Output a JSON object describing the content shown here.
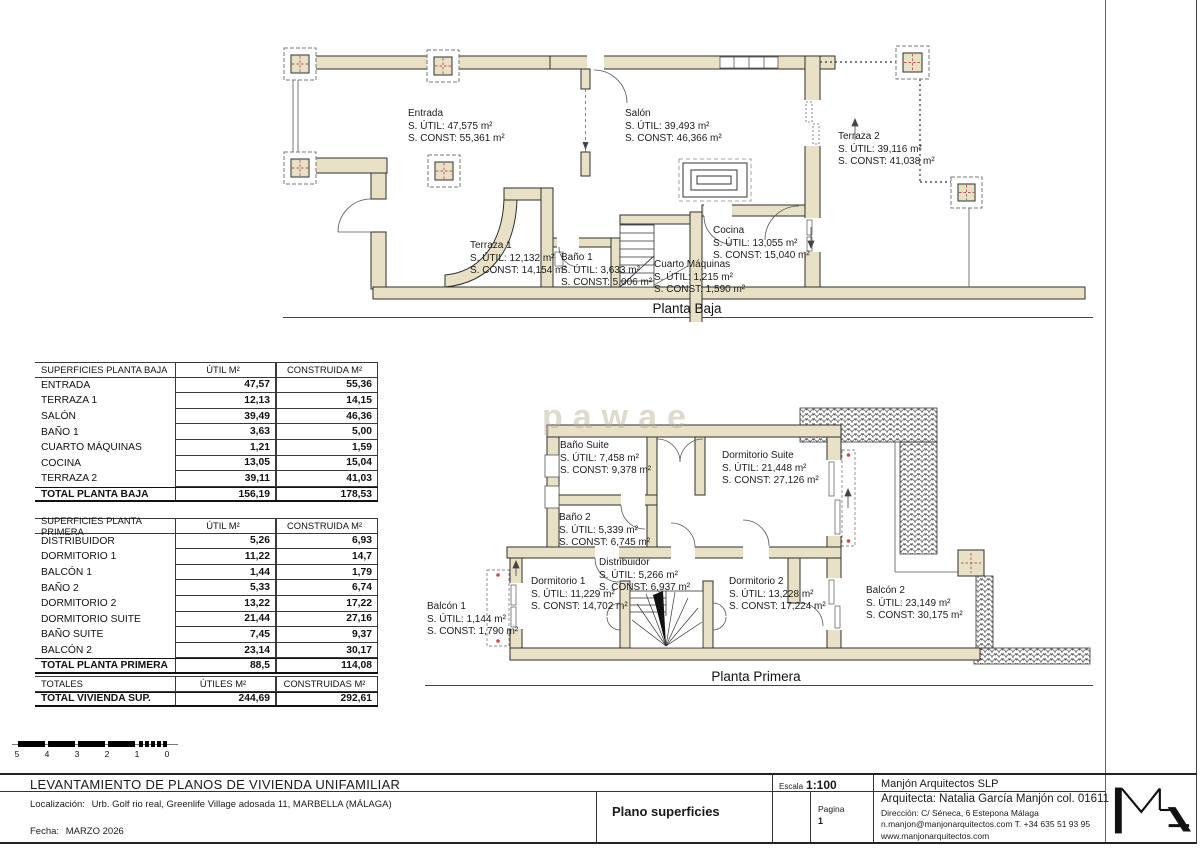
{
  "watermark": "pawae",
  "plans": {
    "planta_baja": {
      "caption": "Planta Baja",
      "rooms": [
        {
          "id": "entrada",
          "lines": [
            "Entrada",
            "S. ÚTIL: 47,575 m²",
            "S. CONST: 55,361 m²"
          ]
        },
        {
          "id": "salon",
          "lines": [
            "Salón",
            "S. ÚTIL: 39,493 m²",
            "S. CONST: 46,366 m²"
          ]
        },
        {
          "id": "terraza2",
          "lines": [
            "Terraza 2",
            "S. ÚTIL: 39,116 m²",
            "S. CONST: 41,038 m²"
          ]
        },
        {
          "id": "terraza1",
          "lines": [
            "Terraza 1",
            "S. ÚTIL: 12,132 m²",
            "S. CONST: 14,154 m²"
          ]
        },
        {
          "id": "bano1",
          "lines": [
            "Baño 1",
            "S. ÚTIL: 3,633 m²",
            "S. CONST: 5,006 m²"
          ]
        },
        {
          "id": "cuarto_maquinas",
          "lines": [
            "Cuarto Máquinas",
            "S. ÚTIL: 1,215 m²",
            "S. CONST: 1,590 m²"
          ]
        },
        {
          "id": "cocina",
          "lines": [
            "Cocina",
            "S. ÚTIL: 13,055 m²",
            "S. CONST: 15,040 m²"
          ]
        }
      ]
    },
    "planta_primera": {
      "caption": "Planta Primera",
      "rooms": [
        {
          "id": "bano_suite",
          "lines": [
            "Baño Suite",
            "S. ÚTIL: 7,458 m²",
            "S. CONST: 9,378 m²"
          ]
        },
        {
          "id": "dormitorio_suite",
          "lines": [
            "Dormitorio Suite",
            "S. ÚTIL: 21,448 m²",
            "S. CONST: 27,126 m²"
          ]
        },
        {
          "id": "bano2",
          "lines": [
            "Baño 2",
            "S. ÚTIL: 5,339 m²",
            "S. CONST: 6,745 m²"
          ]
        },
        {
          "id": "distribuidor",
          "lines": [
            "Distribuidor",
            "S. ÚTIL: 5,266 m²",
            "S. CONST: 6,937 m²"
          ]
        },
        {
          "id": "dormitorio1",
          "lines": [
            "Dormitorio 1",
            "S. ÚTIL: 11,229 m²",
            "S. CONST: 14,702 m²"
          ]
        },
        {
          "id": "dormitorio2",
          "lines": [
            "Dormitorio 2",
            "S. ÚTIL: 13,228 m²",
            "S. CONST: 17,224 m²"
          ]
        },
        {
          "id": "balcon1",
          "lines": [
            "Balcón 1",
            "S. ÚTIL: 1,144 m²",
            "S. CONST: 1,790 m²"
          ]
        },
        {
          "id": "balcon2",
          "lines": [
            "Balcón 2",
            "S. ÚTIL: 23,149 m²",
            "S. CONST: 30,175 m²"
          ]
        }
      ]
    }
  },
  "tables": [
    {
      "id": "planta_baja",
      "headers": [
        "SUPERFICIES PLANTA BAJA",
        "ÚTIL M²",
        "CONSTRUIDA M²"
      ],
      "rows": [
        [
          "ENTRADA",
          "47,57",
          "55,36"
        ],
        [
          "TERRAZA 1",
          "12,13",
          "14,15"
        ],
        [
          "SALÓN",
          "39,49",
          "46,36"
        ],
        [
          "BAÑO 1",
          "3,63",
          "5,00"
        ],
        [
          "CUARTO MÁQUINAS",
          "1,21",
          "1,59"
        ],
        [
          "COCINA",
          "13,05",
          "15,04"
        ],
        [
          "TERRAZA 2",
          "39,11",
          "41,03"
        ]
      ],
      "total": [
        "TOTAL PLANTA BAJA",
        "156,19",
        "178,53"
      ]
    },
    {
      "id": "planta_primera",
      "headers": [
        "SUPERFICIES PLANTA PRIMERA",
        "ÚTIL M²",
        "CONSTRUIDA M²"
      ],
      "rows": [
        [
          "DISTRIBUIDOR",
          "5,26",
          "6,93"
        ],
        [
          "DORMITORIO 1",
          "11,22",
          "14,7"
        ],
        [
          "BALCÓN 1",
          "1,44",
          "1,79"
        ],
        [
          "BAÑO 2",
          "5,33",
          "6,74"
        ],
        [
          "DORMITORIO 2",
          "13,22",
          "17,22"
        ],
        [
          "DORMITORIO SUITE",
          "21,44",
          "27,16"
        ],
        [
          "BAÑO SUITE",
          "7,45",
          "9,37"
        ],
        [
          "BALCÓN 2",
          "23,14",
          "30,17"
        ]
      ],
      "total": [
        "TOTAL PLANTA PRIMERA",
        "88,5",
        "114,08"
      ]
    },
    {
      "id": "totales",
      "headers": [
        "TOTALES",
        "ÚTILES M²",
        "CONSTRUIDAS M²"
      ],
      "rows": [],
      "total": [
        "TOTAL VIVIENDA SUP.",
        "244,69",
        "292,61"
      ]
    }
  ],
  "scalebar": {
    "labels": [
      "5",
      "4",
      "3",
      "2",
      "1",
      "0"
    ]
  },
  "titleblock": {
    "title": "LEVANTAMIENTO DE PLANOS DE VIVIENDA UNIFAMILIAR",
    "location_label": "Localización:",
    "location": "Urb. Golf rio real, Greenlife Village adosada 11, MARBELLA (MÁLAGA)",
    "date_label": "Fecha:",
    "date": "MARZO 2026",
    "sheet_name": "Plano superficies",
    "scale_label": "Escala",
    "scale_value": "1:100",
    "page_label": "Pagina",
    "page_number": "1",
    "firm": "Manjón Arquitectos SLP",
    "architect": "Arquitecta: Natalia García Manjón col. 01611",
    "address": "Dirección: C/ Séneca, 6 Estepona Málaga",
    "contact": "n.manjon@manjonarquitectos.com T. +34 635 51 93 95",
    "website": "www.manjonarquitectos.com"
  },
  "colors": {
    "wall": "#e9e1c6",
    "wall_stroke": "#2e2e2e",
    "column_red": "#c0504d",
    "line": "#444444"
  }
}
